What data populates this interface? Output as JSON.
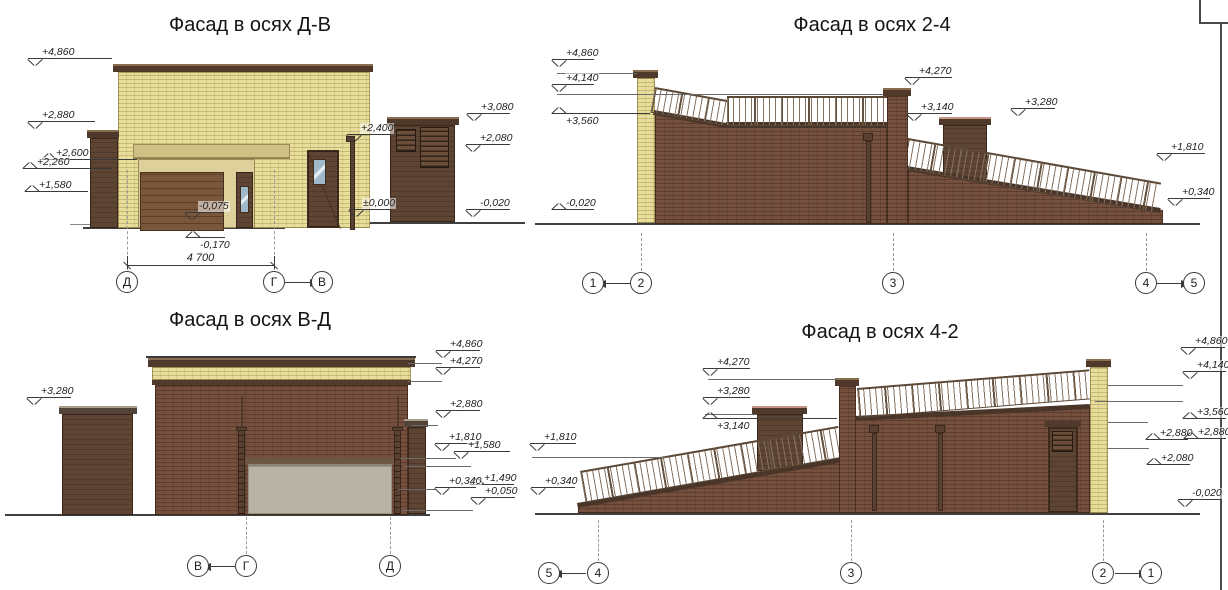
{
  "sheet": {
    "width": 1228,
    "height": 590,
    "background": "#ffffff",
    "frame": {
      "border_x": 1220,
      "corner_box": {
        "x": 1199,
        "y": -2,
        "w": 40,
        "h": 26
      }
    }
  },
  "colors": {
    "yellow_brick": "#e8de9c",
    "red_brick": "#75503f",
    "wood_brown": "#5e4433",
    "cap_dark": "#4e392b",
    "tan_lintel": "#cfc083",
    "gray_door": "#b6b2a4",
    "glass_blue": "#9fb9ca",
    "annotation_line": "#3a3a3a"
  },
  "panels": [
    {
      "id": "facade-d-v",
      "title": "Фасад в осях Д-В",
      "title_cx": 250,
      "title_top": 14,
      "marks": [
        {
          "label": "+4,860",
          "x": 28,
          "y": 58,
          "w": 84,
          "dir": "down"
        },
        {
          "label": "+2,880",
          "x": 28,
          "y": 121,
          "w": 67,
          "dir": "down"
        },
        {
          "label": "+2,600",
          "x": 42,
          "y": 159,
          "w": 95,
          "dir": "up"
        },
        {
          "label": "+2,260",
          "x": 23,
          "y": 168,
          "w": 89,
          "dir": "up"
        },
        {
          "label": "+1,580",
          "x": 25,
          "y": 191,
          "w": 63,
          "dir": "up"
        },
        {
          "label": "-0,075",
          "x": 185,
          "y": 212,
          "w": 38,
          "dir": "down"
        },
        {
          "label": "-0,170",
          "x": 186,
          "y": 237,
          "w": 39,
          "dir": "up",
          "lb": true
        },
        {
          "label": "+2,400",
          "x": 347,
          "y": 134,
          "w": 43,
          "dir": "down"
        },
        {
          "label": "±0,000",
          "x": 349,
          "y": 209,
          "w": 41,
          "dir": "down"
        },
        {
          "label": "+3,080",
          "x": 467,
          "y": 113,
          "w": 43,
          "dir": "down"
        },
        {
          "label": "+2,080",
          "x": 466,
          "y": 144,
          "w": 44,
          "dir": "down"
        },
        {
          "label": "-0,020",
          "x": 466,
          "y": 209,
          "w": 44,
          "dir": "down"
        }
      ],
      "dims": [
        {
          "label": "4 700",
          "x": 127,
          "y": 265,
          "w": 147
        }
      ],
      "axes": [
        {
          "label": "Д",
          "x": 127,
          "y": 282
        },
        {
          "label": "Г",
          "x": 274,
          "y": 282
        },
        {
          "label": "В",
          "x": 322,
          "y": 282
        }
      ],
      "links": [
        {
          "x": 285,
          "y": 282,
          "w": 26,
          "head": "right"
        }
      ],
      "dashes": [
        {
          "x": 127,
          "y": 170,
          "h": 100
        },
        {
          "x": 274,
          "y": 170,
          "h": 100
        }
      ],
      "levels": []
    },
    {
      "id": "facade-2-4",
      "title": "Фасад в осях 2-4",
      "title_cx": 872,
      "title_top": 14,
      "marks": [
        {
          "label": "+4,860",
          "x": 552,
          "y": 59,
          "w": 42,
          "dir": "down"
        },
        {
          "label": "+4,140",
          "x": 552,
          "y": 84,
          "w": 42,
          "dir": "down"
        },
        {
          "label": "+3,560",
          "x": 552,
          "y": 113,
          "w": 98,
          "dir": "up",
          "lb": true
        },
        {
          "label": "-0,020",
          "x": 552,
          "y": 209,
          "w": 42,
          "dir": "up"
        },
        {
          "label": "+4,270",
          "x": 905,
          "y": 77,
          "w": 47,
          "dir": "down"
        },
        {
          "label": "+3,140",
          "x": 907,
          "y": 113,
          "w": 45,
          "dir": "down"
        },
        {
          "label": "+3,280",
          "x": 1011,
          "y": 108,
          "w": 44,
          "dir": "down"
        },
        {
          "label": "+1,810",
          "x": 1157,
          "y": 153,
          "w": 48,
          "dir": "down"
        },
        {
          "label": "+0,340",
          "x": 1168,
          "y": 198,
          "w": 42,
          "dir": "down"
        }
      ],
      "dims": [],
      "axes": [
        {
          "label": "1",
          "x": 593,
          "y": 283
        },
        {
          "label": "2",
          "x": 641,
          "y": 283
        },
        {
          "label": "3",
          "x": 893,
          "y": 283
        },
        {
          "label": "4",
          "x": 1146,
          "y": 283
        },
        {
          "label": "5",
          "x": 1194,
          "y": 283
        }
      ],
      "links": [
        {
          "x": 605,
          "y": 283,
          "w": 25,
          "head": "left"
        },
        {
          "x": 1157,
          "y": 283,
          "w": 25,
          "head": "right"
        }
      ],
      "dashes": [
        {
          "x": 641,
          "y": 233,
          "h": 38
        },
        {
          "x": 893,
          "y": 233,
          "h": 38
        },
        {
          "x": 1146,
          "y": 233,
          "h": 38
        }
      ],
      "levels": [
        {
          "x": 557,
          "y": 73,
          "w": 80
        },
        {
          "x": 557,
          "y": 94,
          "w": 326
        }
      ]
    },
    {
      "id": "facade-v-d",
      "title": "Фасад в осях В-Д",
      "title_cx": 250,
      "title_top": 309,
      "marks": [
        {
          "label": "+3,280",
          "x": 27,
          "y": 397,
          "w": 44,
          "dir": "down"
        },
        {
          "label": "+4,860",
          "x": 436,
          "y": 350,
          "w": 44,
          "dir": "down"
        },
        {
          "label": "+4,270",
          "x": 436,
          "y": 367,
          "w": 44,
          "dir": "down"
        },
        {
          "label": "+2,880",
          "x": 436,
          "y": 410,
          "w": 44,
          "dir": "down"
        },
        {
          "label": "+1,810",
          "x": 435,
          "y": 443,
          "w": 44,
          "dir": "down"
        },
        {
          "label": "+1,580",
          "x": 454,
          "y": 451,
          "w": 56,
          "dir": "down"
        },
        {
          "label": "+1,490",
          "x": 470,
          "y": 484,
          "w": 44,
          "dir": "up"
        },
        {
          "label": "+0,340",
          "x": 435,
          "y": 487,
          "w": 41,
          "dir": "down"
        },
        {
          "label": "+0,050",
          "x": 471,
          "y": 497,
          "w": 44,
          "dir": "down"
        }
      ],
      "dims": [],
      "axes": [
        {
          "label": "В",
          "x": 198,
          "y": 566
        },
        {
          "label": "Г",
          "x": 246,
          "y": 566
        },
        {
          "label": "Д",
          "x": 390,
          "y": 566
        }
      ],
      "links": [
        {
          "x": 210,
          "y": 566,
          "w": 25,
          "head": "left"
        }
      ],
      "dashes": [
        {
          "x": 246,
          "y": 517,
          "h": 37
        },
        {
          "x": 390,
          "y": 517,
          "h": 37
        }
      ],
      "levels": [
        {
          "x": 408,
          "y": 363,
          "w": 34
        },
        {
          "x": 408,
          "y": 381,
          "w": 34
        },
        {
          "x": 412,
          "y": 425,
          "w": 26
        },
        {
          "x": 400,
          "y": 458,
          "w": 56
        },
        {
          "x": 404,
          "y": 466,
          "w": 67
        },
        {
          "x": 398,
          "y": 489,
          "w": 38
        },
        {
          "x": 402,
          "y": 510,
          "w": 71
        }
      ]
    },
    {
      "id": "facade-4-2",
      "title": "Фасад в осях 4-2",
      "title_cx": 880,
      "title_top": 321,
      "marks": [
        {
          "label": "+1,810",
          "x": 530,
          "y": 443,
          "w": 46,
          "dir": "down"
        },
        {
          "label": "+0,340",
          "x": 531,
          "y": 487,
          "w": 44,
          "dir": "down"
        },
        {
          "label": "+4,270",
          "x": 703,
          "y": 368,
          "w": 47,
          "dir": "down"
        },
        {
          "label": "+3,280",
          "x": 703,
          "y": 397,
          "w": 47,
          "dir": "down"
        },
        {
          "label": "+3,140",
          "x": 703,
          "y": 418,
          "w": 134,
          "dir": "up",
          "lb": true
        },
        {
          "label": "+4,860",
          "x": 1181,
          "y": 347,
          "w": 44,
          "dir": "down"
        },
        {
          "label": "+4,140",
          "x": 1183,
          "y": 371,
          "w": 43,
          "dir": "down"
        },
        {
          "label": "+3,560",
          "x": 1183,
          "y": 418,
          "w": 43,
          "dir": "up"
        },
        {
          "label": "+2,880",
          "x": 1146,
          "y": 439,
          "w": 42,
          "dir": "up"
        },
        {
          "label": "+2,880",
          "x": 1184,
          "y": 438,
          "w": 42,
          "dir": "up"
        },
        {
          "label": "+2,080",
          "x": 1147,
          "y": 464,
          "w": 43,
          "dir": "up"
        },
        {
          "label": "-0,020",
          "x": 1178,
          "y": 499,
          "w": 44,
          "dir": "down"
        }
      ],
      "dims": [],
      "axes": [
        {
          "label": "5",
          "x": 549,
          "y": 573
        },
        {
          "label": "4",
          "x": 598,
          "y": 573
        },
        {
          "label": "3",
          "x": 851,
          "y": 573
        },
        {
          "label": "2",
          "x": 1103,
          "y": 573
        },
        {
          "label": "1",
          "x": 1151,
          "y": 573
        }
      ],
      "links": [
        {
          "x": 561,
          "y": 573,
          "w": 25,
          "head": "left"
        },
        {
          "x": 1115,
          "y": 573,
          "w": 25,
          "head": "right"
        }
      ],
      "dashes": [
        {
          "x": 598,
          "y": 520,
          "h": 41
        },
        {
          "x": 851,
          "y": 520,
          "h": 41
        },
        {
          "x": 1103,
          "y": 520,
          "h": 41
        }
      ],
      "levels": [
        {
          "x": 532,
          "y": 457,
          "w": 135
        },
        {
          "x": 708,
          "y": 379,
          "w": 130
        },
        {
          "x": 705,
          "y": 414,
          "w": 52
        },
        {
          "x": 1108,
          "y": 385,
          "w": 75
        },
        {
          "x": 1095,
          "y": 401,
          "w": 88
        },
        {
          "x": 1108,
          "y": 422,
          "w": 40
        },
        {
          "x": 1108,
          "y": 448,
          "w": 41
        }
      ]
    }
  ]
}
